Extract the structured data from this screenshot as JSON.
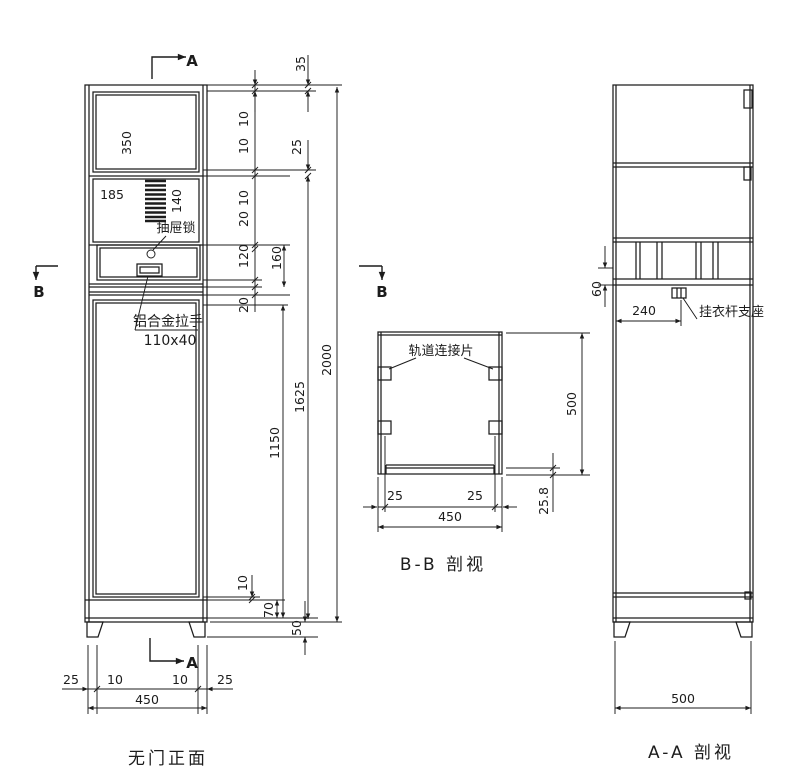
{
  "drawing": {
    "captions": {
      "front": "无门正面",
      "bb": "B-B 剖视",
      "aa": "A-A 剖视"
    },
    "markers": {
      "a": "A",
      "b": "B"
    },
    "front": {
      "labels": {
        "lock": "抽屉锁",
        "handle": "铝合金拉手",
        "handle_size": "110x40"
      },
      "dims": {
        "d350": "350",
        "d185": "185",
        "d140": "140",
        "d35": "35",
        "d10": "10",
        "d25": "25",
        "d20": "20",
        "d120": "120",
        "d160": "160",
        "d1150": "1150",
        "d1625": "1625",
        "d2000": "2000",
        "d70": "70",
        "d50": "50",
        "d450": "450"
      }
    },
    "bb": {
      "labels": {
        "track": "轨道连接片"
      },
      "dims": {
        "d25": "25",
        "d450": "450",
        "d500": "500",
        "d258": "25.8"
      }
    },
    "aa": {
      "labels": {
        "support": "挂衣杆支座"
      },
      "dims": {
        "d60": "60",
        "d240": "240",
        "d500": "500"
      }
    }
  }
}
